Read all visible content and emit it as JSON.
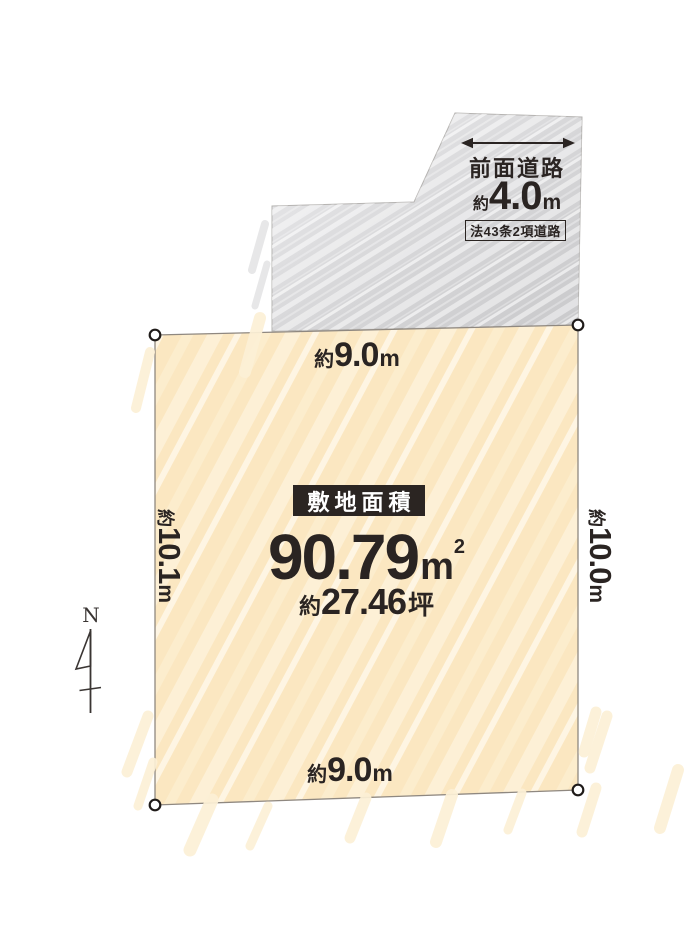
{
  "road": {
    "name": "前面道路",
    "width": {
      "approx": "約",
      "value": "4.0",
      "unit": "m"
    },
    "classification": "法43条2項道路"
  },
  "site": {
    "area_label": "敷地面積",
    "area_sqm": {
      "value": "90.79",
      "unit": "m",
      "sup": "2"
    },
    "area_tsubo": {
      "approx": "約",
      "value": "27.46",
      "unit": "坪"
    }
  },
  "dimensions": {
    "top": {
      "approx": "約",
      "value": "9.0",
      "unit": "m"
    },
    "bottom": {
      "approx": "約",
      "value": "9.0",
      "unit": "m"
    },
    "left": {
      "approx": "約",
      "value": "10.1",
      "unit": "m"
    },
    "right": {
      "approx": "約",
      "value": "10.0",
      "unit": "m"
    }
  },
  "compass": {
    "north": "N"
  },
  "colors": {
    "site_fill": "#fbe7c1",
    "site_stroke_light": "#fdf0d6",
    "road_fill": "#d8d8da",
    "ink": "#2a2422",
    "badge_bg": "#2b2522"
  }
}
